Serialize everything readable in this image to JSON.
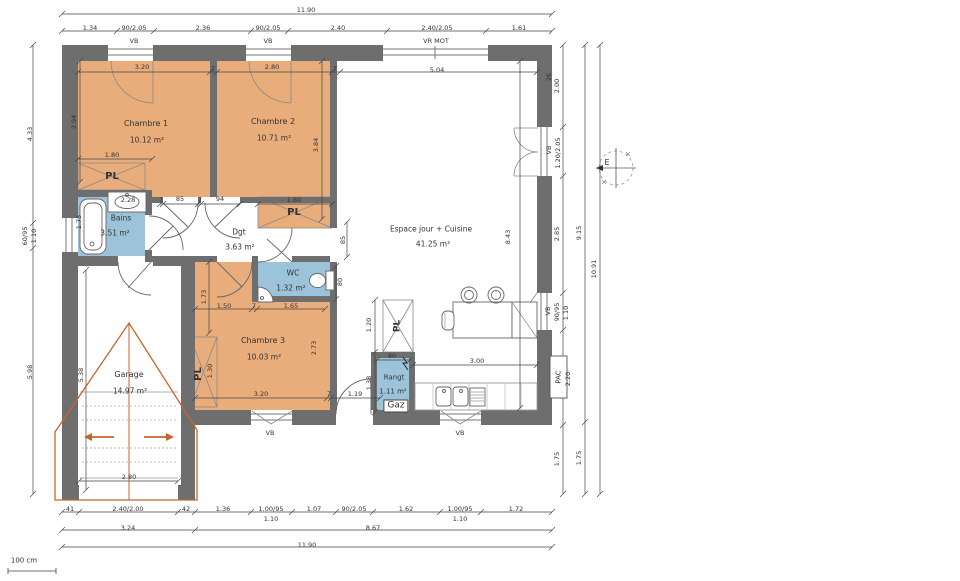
{
  "colors": {
    "wall": "#6e6e6e",
    "room_orange": "#e9ad7c",
    "wet_blue": "#9cc3da",
    "overlay_orange": "#c4662d",
    "dim_line": "#444444",
    "text": "#333333"
  },
  "rooms": [
    {
      "id": "chambre1",
      "label": "Chambre 1",
      "area": "10.12 m²"
    },
    {
      "id": "chambre2",
      "label": "Chambre 2",
      "area": "10.71 m²"
    },
    {
      "id": "chambre3",
      "label": "Chambre 3",
      "area": "10.03 m²"
    },
    {
      "id": "bains",
      "label": "Bains",
      "area": "3.51 m²"
    },
    {
      "id": "wc",
      "label": "WC",
      "area": "1.32 m²"
    },
    {
      "id": "degagement",
      "label": "Dgt",
      "area": "3.63 m²"
    },
    {
      "id": "espace-jour",
      "label": "Espace jour + Cuisine",
      "area": "41.25 m²"
    },
    {
      "id": "garage",
      "label": "Garage",
      "area": "14.97 m²"
    },
    {
      "id": "rangement",
      "label": "Rangt",
      "area": "1.11 m²"
    }
  ],
  "annotations": [
    {
      "n": "dim-total-top",
      "t": "11.90",
      "x": 306,
      "y": 10
    },
    {
      "n": "dim-top",
      "t": "1.34",
      "x": 90,
      "y": 28
    },
    {
      "n": "dim-top-window1",
      "t": "90/2.05",
      "x": 134,
      "y": 28
    },
    {
      "n": "dim-top",
      "t": "2.36",
      "x": 203,
      "y": 28
    },
    {
      "n": "dim-top-window2",
      "t": "90/2.05",
      "x": 268,
      "y": 28
    },
    {
      "n": "dim-top",
      "t": "2.40",
      "x": 338,
      "y": 28
    },
    {
      "n": "dim-top-window3",
      "t": "2.40/2.05",
      "x": 437,
      "y": 28
    },
    {
      "n": "dim-top",
      "t": "1.61",
      "x": 519,
      "y": 28
    },
    {
      "n": "window-label-vb1",
      "t": "VB",
      "x": 134,
      "y": 41
    },
    {
      "n": "window-label-vb2",
      "t": "VB",
      "x": 268,
      "y": 41
    },
    {
      "n": "window-label-vrmot",
      "t": "VR MOT",
      "x": 436,
      "y": 41
    },
    {
      "n": "dim-interior",
      "t": "3.20",
      "x": 142,
      "y": 67
    },
    {
      "n": "dim-wall7",
      "t": "7",
      "x": 213,
      "y": 69
    },
    {
      "n": "dim-interior",
      "t": "2.80",
      "x": 272,
      "y": 67
    },
    {
      "n": "dim-wall7",
      "t": "7",
      "x": 335,
      "y": 69
    },
    {
      "n": "dim-interior",
      "t": "5.04",
      "x": 437,
      "y": 70
    },
    {
      "n": "dim-wall26",
      "t": "26",
      "x": 549,
      "y": 77,
      "v": true
    },
    {
      "n": "dim-left",
      "t": "4.33",
      "x": 30,
      "y": 134,
      "v": true
    },
    {
      "n": "dim-left-window",
      "t": "60/95",
      "x": 25,
      "y": 236,
      "v": true
    },
    {
      "n": "dim-left-sill",
      "t": "1.10",
      "x": 34,
      "y": 236,
      "v": true
    },
    {
      "n": "dim-left",
      "t": "5.98",
      "x": 30,
      "y": 372,
      "v": true
    },
    {
      "n": "dim-interior",
      "t": "2.94",
      "x": 74,
      "y": 122,
      "v": true
    },
    {
      "n": "room-label-chambre1",
      "t": "Chambre 1",
      "x": 146,
      "y": 124,
      "s": 8
    },
    {
      "n": "room-area-chambre1",
      "t": "10.12 m²",
      "x": 147,
      "y": 140,
      "s": 7.5
    },
    {
      "n": "dim-interior",
      "t": "1.80",
      "x": 112,
      "y": 155
    },
    {
      "n": "closet-label-pl1",
      "t": "PL",
      "x": 112,
      "y": 177,
      "s": 10,
      "b": true
    },
    {
      "n": "dim-interior",
      "t": "2.28",
      "x": 128,
      "y": 200
    },
    {
      "n": "room-label-bains",
      "t": "Bains",
      "x": 121,
      "y": 218,
      "s": 7.5
    },
    {
      "n": "room-area-bains",
      "t": "3.51 m²",
      "x": 115,
      "y": 233,
      "s": 7.5
    },
    {
      "n": "dim-interior",
      "t": "1.75",
      "x": 79,
      "y": 222,
      "v": true
    },
    {
      "n": "room-label-chambre2",
      "t": "Chambre 2",
      "x": 273,
      "y": 122,
      "s": 8
    },
    {
      "n": "room-area-chambre2",
      "t": "10.71 m²",
      "x": 274,
      "y": 138,
      "s": 7.5
    },
    {
      "n": "dim-interior",
      "t": "3.84",
      "x": 316,
      "y": 145,
      "v": true
    },
    {
      "n": "dim-wall7",
      "t": "7",
      "x": 161,
      "y": 200
    },
    {
      "n": "dim-door",
      "t": "85",
      "x": 180,
      "y": 199
    },
    {
      "n": "dim-wall7",
      "t": "7",
      "x": 200,
      "y": 200
    },
    {
      "n": "dim-door",
      "t": "94",
      "x": 220,
      "y": 199
    },
    {
      "n": "dim-interior",
      "t": "1.80",
      "x": 294,
      "y": 200
    },
    {
      "n": "closet-label-pl2",
      "t": "PL",
      "x": 294,
      "y": 213,
      "s": 10,
      "b": true
    },
    {
      "n": "room-label-dgt",
      "t": "Dgt",
      "x": 239,
      "y": 232,
      "s": 7.5
    },
    {
      "n": "room-area-dgt",
      "t": "3.63 m²",
      "x": 240,
      "y": 247,
      "s": 7.5
    },
    {
      "n": "dim-interior",
      "t": "85",
      "x": 343,
      "y": 240,
      "v": true
    },
    {
      "n": "room-label-wc",
      "t": "WC",
      "x": 293,
      "y": 273,
      "s": 7.5
    },
    {
      "n": "room-area-wc",
      "t": "1.32 m²",
      "x": 291,
      "y": 288,
      "s": 7.5
    },
    {
      "n": "dim-interior",
      "t": "80",
      "x": 340,
      "y": 282,
      "v": true
    },
    {
      "n": "dim-interior",
      "t": "1.73",
      "x": 204,
      "y": 297,
      "v": true
    },
    {
      "n": "dim-interior",
      "t": "1.50",
      "x": 224,
      "y": 306
    },
    {
      "n": "dim-wall7",
      "t": "7",
      "x": 254,
      "y": 306
    },
    {
      "n": "dim-interior",
      "t": "1.65",
      "x": 291,
      "y": 306
    },
    {
      "n": "room-label-chambre3",
      "t": "Chambre 3",
      "x": 263,
      "y": 341,
      "s": 8
    },
    {
      "n": "room-area-chambre3",
      "t": "10.03 m²",
      "x": 264,
      "y": 357,
      "s": 7.5
    },
    {
      "n": "closet-label-pl3",
      "t": "PL",
      "x": 199,
      "y": 374,
      "s": 10,
      "b": true,
      "v": true
    },
    {
      "n": "dim-interior",
      "t": "1.30",
      "x": 210,
      "y": 371,
      "v": true
    },
    {
      "n": "dim-interior",
      "t": "2.73",
      "x": 314,
      "y": 348,
      "v": true
    },
    {
      "n": "dim-interior",
      "t": "3.20",
      "x": 261,
      "y": 394
    },
    {
      "n": "dim-wall7",
      "t": "7",
      "x": 329,
      "y": 394
    },
    {
      "n": "dim-interior",
      "t": "1.19",
      "x": 355,
      "y": 394
    },
    {
      "n": "window-label-vb-chambre3",
      "t": "VB",
      "x": 270,
      "y": 433
    },
    {
      "n": "room-label-espace-jour",
      "t": "Espace jour + Cuisine",
      "x": 431,
      "y": 229,
      "s": 7.5
    },
    {
      "n": "room-area-espace-jour",
      "t": "41.25 m²",
      "x": 433,
      "y": 244,
      "s": 7.5
    },
    {
      "n": "dim-interior",
      "t": "8.43",
      "x": 508,
      "y": 237,
      "v": true
    },
    {
      "n": "dim-interior",
      "t": "1.20",
      "x": 369,
      "y": 325,
      "v": true
    },
    {
      "n": "closet-label-pl-entry",
      "t": "PL",
      "x": 398,
      "y": 326,
      "s": 9,
      "b": true,
      "v": true
    },
    {
      "n": "dim-interior",
      "t": "1.38",
      "x": 369,
      "y": 383,
      "v": true
    },
    {
      "n": "dim-interior",
      "t": "80",
      "x": 392,
      "y": 356
    },
    {
      "n": "room-label-rangt",
      "t": "Rangt",
      "x": 394,
      "y": 378,
      "s": 7
    },
    {
      "n": "room-area-rangt",
      "t": "1.11 m²",
      "x": 393,
      "y": 392,
      "s": 7
    },
    {
      "n": "gaz-label",
      "t": "Gaz",
      "x": 396,
      "y": 406,
      "s": 9,
      "box": true
    },
    {
      "n": "dim-interior",
      "t": "3.00",
      "x": 477,
      "y": 361
    },
    {
      "n": "window-label-vb-cuisine",
      "t": "VB",
      "x": 460,
      "y": 433
    },
    {
      "n": "dim-right",
      "t": "2.00",
      "x": 557,
      "y": 86,
      "v": true
    },
    {
      "n": "window-label-vb-sejour",
      "t": "VB",
      "x": 549,
      "y": 150,
      "v": true
    },
    {
      "n": "dim-right-window",
      "t": "1.20/2.05",
      "x": 558,
      "y": 153,
      "v": true
    },
    {
      "n": "dim-right",
      "t": "2.85",
      "x": 557,
      "y": 234,
      "v": true
    },
    {
      "n": "window-label-vb-kitchen",
      "t": "VB",
      "x": 548,
      "y": 311,
      "v": true
    },
    {
      "n": "dim-right-window",
      "t": "90/95",
      "x": 557,
      "y": 312,
      "v": true
    },
    {
      "n": "dim-right-sill",
      "t": "1.10",
      "x": 566,
      "y": 313,
      "v": true
    },
    {
      "n": "pac-label",
      "t": "PAC",
      "x": 559,
      "y": 377,
      "s": 7,
      "v": true
    },
    {
      "n": "dim-right",
      "t": "2.20",
      "x": 568,
      "y": 379,
      "v": true
    },
    {
      "n": "dim-right",
      "t": "1.75",
      "x": 557,
      "y": 459,
      "v": true
    },
    {
      "n": "dim-right",
      "t": "9.15",
      "x": 579,
      "y": 233,
      "v": true
    },
    {
      "n": "dim-right",
      "t": "1.75",
      "x": 579,
      "y": 458,
      "v": true
    },
    {
      "n": "dim-right-total",
      "t": "10.91",
      "x": 594,
      "y": 269,
      "v": true
    },
    {
      "n": "dim-interior",
      "t": "5.38",
      "x": 81,
      "y": 375,
      "v": true
    },
    {
      "n": "room-label-garage",
      "t": "Garage",
      "x": 129,
      "y": 375,
      "s": 8
    },
    {
      "n": "room-area-garage",
      "t": "14.97 m²",
      "x": 130,
      "y": 391,
      "s": 7.5
    },
    {
      "n": "dim-interior",
      "t": "2.80",
      "x": 129,
      "y": 477
    },
    {
      "n": "dim-bottom",
      "t": "41",
      "x": 70,
      "y": 509
    },
    {
      "n": "dim-bottom-garage-door",
      "t": "2.40/2.00",
      "x": 128,
      "y": 509
    },
    {
      "n": "dim-bottom",
      "t": "42",
      "x": 186,
      "y": 509
    },
    {
      "n": "dim-bottom",
      "t": "1.36",
      "x": 223,
      "y": 509
    },
    {
      "n": "dim-bottom-window",
      "t": "1.00/95",
      "x": 271,
      "y": 509
    },
    {
      "n": "dim-bottom-sill",
      "t": "1.10",
      "x": 271,
      "y": 519
    },
    {
      "n": "dim-bottom",
      "t": "1.07",
      "x": 314,
      "y": 509
    },
    {
      "n": "dim-bottom-door",
      "t": "90/2.05",
      "x": 354,
      "y": 509
    },
    {
      "n": "dim-bottom",
      "t": "1.62",
      "x": 406,
      "y": 509
    },
    {
      "n": "dim-bottom-window",
      "t": "1.00/95",
      "x": 460,
      "y": 509
    },
    {
      "n": "dim-bottom-sill",
      "t": "1.10",
      "x": 460,
      "y": 519
    },
    {
      "n": "dim-bottom",
      "t": "1.72",
      "x": 516,
      "y": 509
    },
    {
      "n": "dim-bottom",
      "t": "3.24",
      "x": 128,
      "y": 528
    },
    {
      "n": "dim-bottom",
      "t": "8.67",
      "x": 373,
      "y": 528
    },
    {
      "n": "dim-total-bottom",
      "t": "11.90",
      "x": 307,
      "y": 545
    },
    {
      "n": "scale-bar-label",
      "t": "100 cm",
      "x": 24,
      "y": 561,
      "s": 7
    },
    {
      "n": "compass-east-label",
      "t": "E",
      "x": 607,
      "y": 163,
      "s": 8
    }
  ]
}
